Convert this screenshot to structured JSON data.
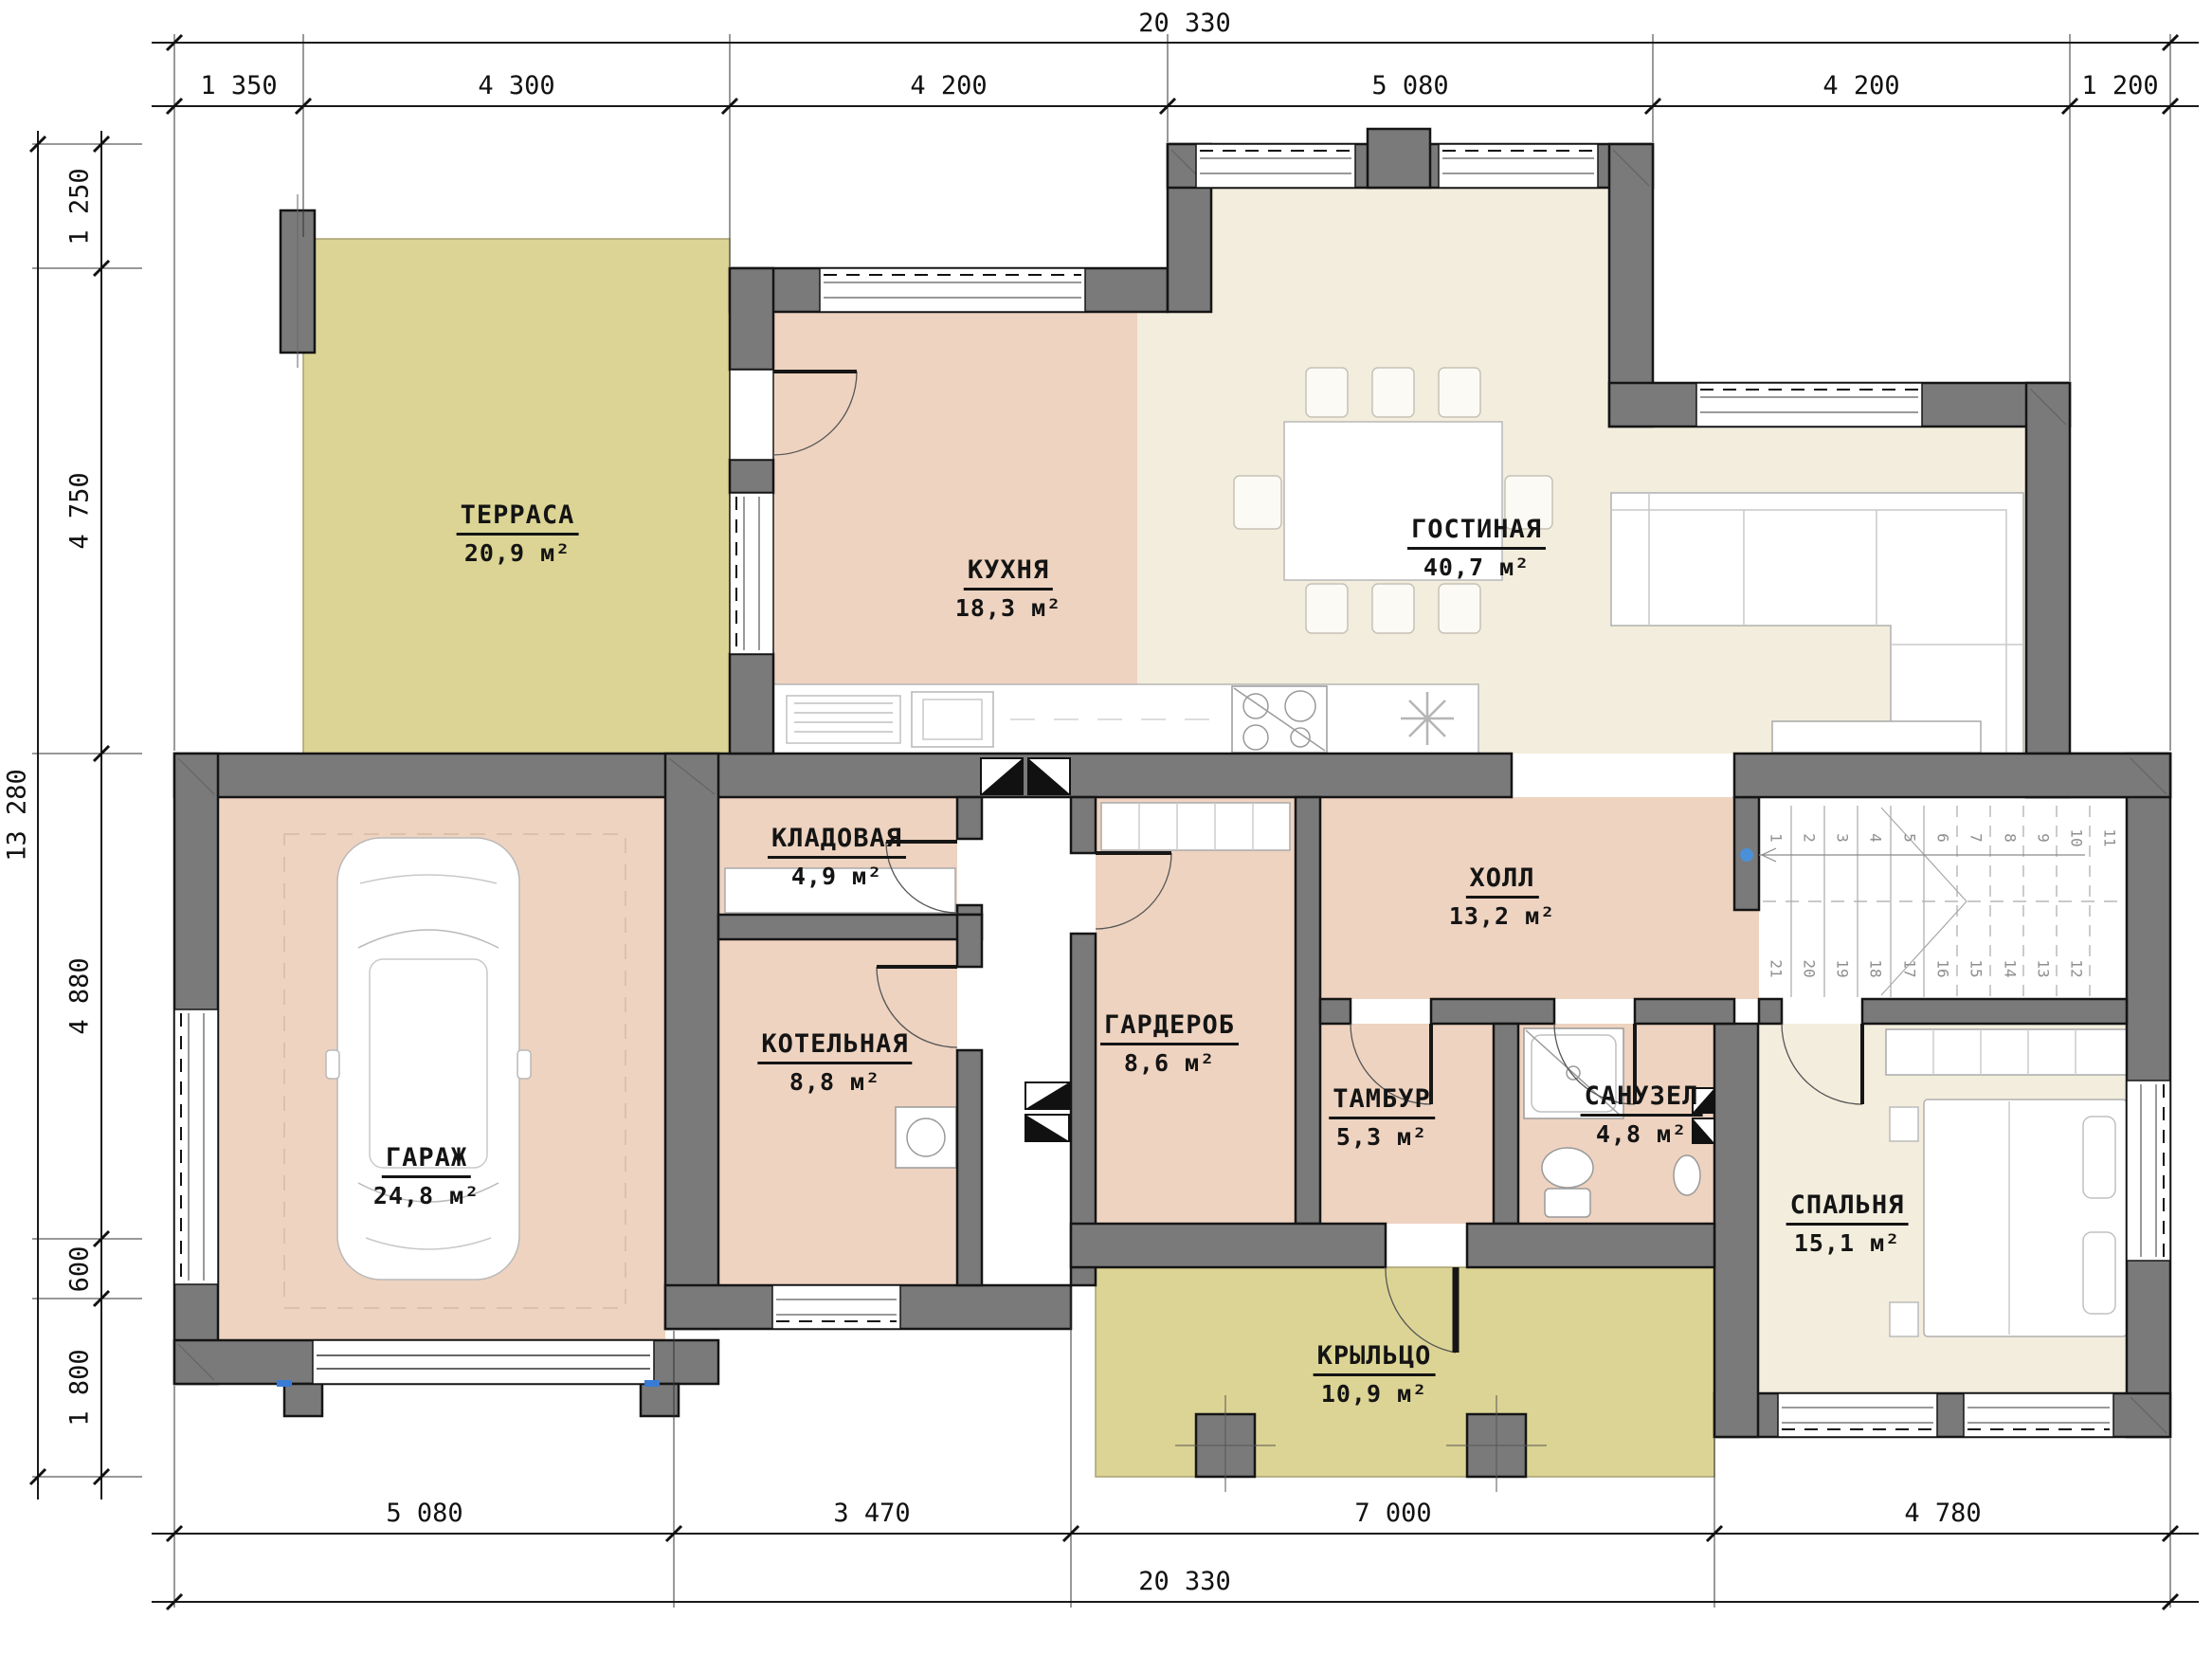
{
  "rooms": [
    {
      "id": "terrace",
      "name": "ТЕРРАСА",
      "area": "20,9 м²"
    },
    {
      "id": "kitchen",
      "name": "КУХНЯ",
      "area": "18,3 м²"
    },
    {
      "id": "living",
      "name": "ГОСТИНАЯ",
      "area": "40,7 м²"
    },
    {
      "id": "pantry",
      "name": "КЛАДОВАЯ",
      "area": "4,9 м²"
    },
    {
      "id": "hall",
      "name": "ХОЛЛ",
      "area": "13,2 м²"
    },
    {
      "id": "boiler",
      "name": "КОТЕЛЬНАЯ",
      "area": "8,8 м²"
    },
    {
      "id": "wardrobe",
      "name": "ГАРДЕРОБ",
      "area": "8,6 м²"
    },
    {
      "id": "vestibule",
      "name": "ТАМБУР",
      "area": "5,3 м²"
    },
    {
      "id": "bathroom",
      "name": "САНУЗЕЛ",
      "area": "4,8 м²"
    },
    {
      "id": "garage",
      "name": "ГАРАЖ",
      "area": "24,8 м²"
    },
    {
      "id": "bedroom",
      "name": "СПАЛЬНЯ",
      "area": "15,1 м²"
    },
    {
      "id": "porch",
      "name": "КРЫЛЬЦО",
      "area": "10,9 м²"
    }
  ],
  "dimensions": {
    "top": {
      "total": "20 330",
      "segments": [
        "1 350",
        "4 300",
        "4 200",
        "5 080",
        "4 200",
        "1 200"
      ]
    },
    "left": {
      "total": "13 280",
      "segments": [
        "1 250",
        "4 750",
        "4 880",
        "600",
        "1 800"
      ]
    },
    "bottom": {
      "total": "20 330",
      "segments": [
        "5 080",
        "3 470",
        "7 000",
        "4 780"
      ]
    }
  },
  "stairs": {
    "steps_top": [
      "1",
      "2",
      "3",
      "4",
      "5",
      "6",
      "7",
      "8",
      "9",
      "10",
      "11"
    ],
    "steps_bottom": [
      "21",
      "20",
      "19",
      "18",
      "17",
      "16",
      "15",
      "14",
      "13",
      "12"
    ]
  },
  "colors": {
    "wall": "#7a7a7a",
    "room_warm": "#eed3c0",
    "room_light": "#f3eddd",
    "outdoor": "#dcd494",
    "stair_marker_blue": "#4a90d9"
  }
}
